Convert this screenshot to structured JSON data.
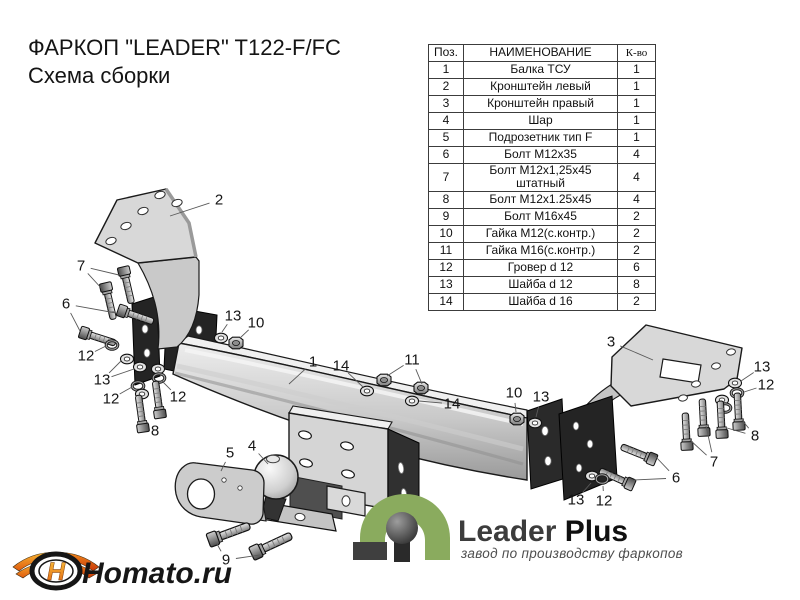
{
  "title": {
    "line1": "ФАРКОП \"LEADER\" T122-F/FC",
    "line2": "Схема сборки"
  },
  "parts_table": {
    "headers": {
      "pos": "Поз.",
      "name": "НАИМЕНОВАНИЕ",
      "qty": "К-во"
    },
    "rows": [
      {
        "pos": "1",
        "name": "Балка ТСУ",
        "qty": "1"
      },
      {
        "pos": "2",
        "name": "Кронштейн левый",
        "qty": "1"
      },
      {
        "pos": "3",
        "name": "Кронштейн правый",
        "qty": "1"
      },
      {
        "pos": "4",
        "name": "Шар",
        "qty": "1"
      },
      {
        "pos": "5",
        "name": "Подрозетник тип F",
        "qty": "1"
      },
      {
        "pos": "6",
        "name": "Болт М12х35",
        "qty": "4"
      },
      {
        "pos": "7",
        "name": "Болт М12х1,25х45 штатный",
        "qty": "4"
      },
      {
        "pos": "8",
        "name": "Болт М12х1.25х45",
        "qty": "4"
      },
      {
        "pos": "9",
        "name": "Болт М16х45",
        "qty": "2"
      },
      {
        "pos": "10",
        "name": "Гайка М12(с.контр.)",
        "qty": "2"
      },
      {
        "pos": "11",
        "name": "Гайка М16(с.контр.)",
        "qty": "2"
      },
      {
        "pos": "12",
        "name": "Гровер d 12",
        "qty": "6"
      },
      {
        "pos": "13",
        "name": "Шайба d 12",
        "qty": "8"
      },
      {
        "pos": "14",
        "name": "Шайба d 16",
        "qty": "2"
      }
    ]
  },
  "diagram": {
    "leader_color": "#5a5a5a",
    "label_color": "#161616",
    "label_font_size": 15,
    "callouts": [
      {
        "label": "2",
        "x": 219,
        "y": 200,
        "targets": [
          [
            170,
            216
          ]
        ]
      },
      {
        "label": "7",
        "x": 81,
        "y": 266,
        "targets": [
          [
            119,
            275
          ],
          [
            103,
            290
          ]
        ]
      },
      {
        "label": "6",
        "x": 66,
        "y": 304,
        "targets": [
          [
            116,
            313
          ],
          [
            80,
            331
          ]
        ]
      },
      {
        "label": "12",
        "x": 86,
        "y": 356,
        "targets": [
          [
            106,
            346
          ]
        ]
      },
      {
        "label": "13",
        "x": 102,
        "y": 380,
        "targets": [
          [
            121,
            361
          ],
          [
            134,
            369
          ]
        ]
      },
      {
        "label": "12",
        "x": 111,
        "y": 399,
        "targets": [
          [
            132,
            387
          ]
        ]
      },
      {
        "label": "12",
        "x": 178,
        "y": 397,
        "targets": [
          [
            162,
            381
          ]
        ]
      },
      {
        "label": "8",
        "x": 155,
        "y": 431,
        "targets": [
          [
            147,
            422
          ]
        ]
      },
      {
        "label": "13",
        "x": 233,
        "y": 316,
        "targets": [
          [
            222,
            332
          ]
        ]
      },
      {
        "label": "10",
        "x": 256,
        "y": 323,
        "targets": [
          [
            240,
            338
          ]
        ]
      },
      {
        "label": "1",
        "x": 313,
        "y": 362,
        "targets": [
          [
            289,
            384
          ]
        ]
      },
      {
        "label": "14",
        "x": 341,
        "y": 366,
        "targets": [
          [
            363,
            387
          ]
        ]
      },
      {
        "label": "11",
        "x": 412,
        "y": 360,
        "targets": [
          [
            387,
            376
          ],
          [
            422,
            384
          ]
        ]
      },
      {
        "label": "14",
        "x": 452,
        "y": 404,
        "targets": [
          [
            419,
            401
          ]
        ]
      },
      {
        "label": "5",
        "x": 230,
        "y": 453,
        "targets": [
          [
            221,
            471
          ]
        ]
      },
      {
        "label": "4",
        "x": 252,
        "y": 446,
        "targets": [
          [
            268,
            464
          ]
        ]
      },
      {
        "label": "9",
        "x": 226,
        "y": 560,
        "targets": [
          [
            217,
            544
          ],
          [
            260,
            555
          ]
        ]
      },
      {
        "label": "10",
        "x": 514,
        "y": 393,
        "targets": [
          [
            516,
            412
          ]
        ]
      },
      {
        "label": "13",
        "x": 541,
        "y": 397,
        "targets": [
          [
            536,
            417
          ]
        ]
      },
      {
        "label": "3",
        "x": 611,
        "y": 342,
        "targets": [
          [
            653,
            360
          ]
        ]
      },
      {
        "label": "13",
        "x": 762,
        "y": 367,
        "targets": [
          [
            741,
            381
          ]
        ]
      },
      {
        "label": "12",
        "x": 766,
        "y": 385,
        "targets": [
          [
            744,
            392
          ]
        ]
      },
      {
        "label": "8",
        "x": 755,
        "y": 436,
        "targets": [
          [
            742,
            420
          ],
          [
            727,
            428
          ]
        ]
      },
      {
        "label": "7",
        "x": 714,
        "y": 462,
        "targets": [
          [
            706,
            426
          ],
          [
            690,
            440
          ]
        ]
      },
      {
        "label": "6",
        "x": 676,
        "y": 478,
        "targets": [
          [
            655,
            456
          ],
          [
            634,
            480
          ]
        ]
      },
      {
        "label": "13",
        "x": 576,
        "y": 500,
        "targets": [
          [
            591,
            483
          ]
        ]
      },
      {
        "label": "12",
        "x": 604,
        "y": 501,
        "targets": [
          [
            603,
            486
          ]
        ]
      }
    ]
  },
  "branding": {
    "leader_plus": {
      "name_regular": "Leader ",
      "name_bold": "Plus",
      "tagline": "завод по производству фаркопов",
      "green": "#8aab5e"
    },
    "homato": {
      "text": "Homato.ru",
      "emblem_letter": "H",
      "orange": "#ef8c1a"
    }
  }
}
